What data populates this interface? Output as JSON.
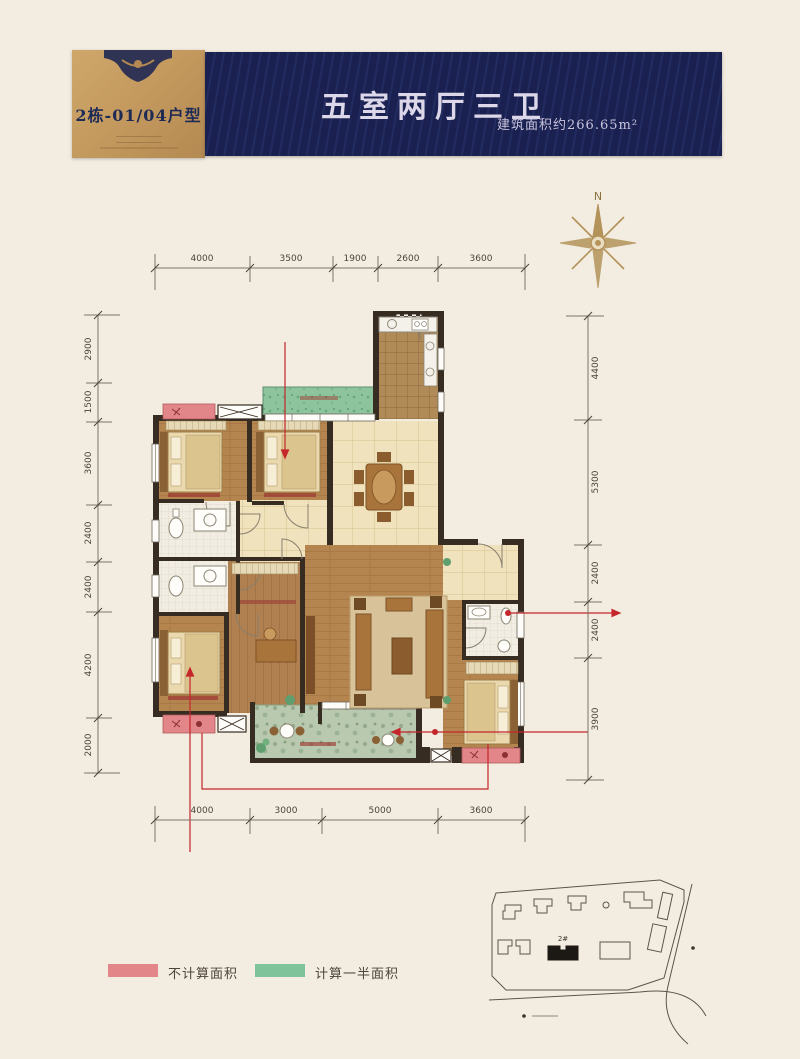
{
  "header": {
    "unit_label": "2栋-01/04户型",
    "title": "五室两厅三卫",
    "area_note": "建筑面积约266.65m²"
  },
  "compass": {
    "label": "N"
  },
  "dimensions": {
    "top": [
      "4000",
      "3500",
      "1900",
      "2600",
      "3600"
    ],
    "bottom": [
      "4000",
      "3000",
      "5000",
      "3600"
    ],
    "left": [
      "2900",
      "1500",
      "3600",
      "2400",
      "2400",
      "4200",
      "2000"
    ],
    "right": [
      "4400",
      "5300",
      "2400",
      "2400",
      "3900"
    ]
  },
  "legend": {
    "items": [
      {
        "label": "不计算面积",
        "color": "#e2868a"
      },
      {
        "label": "计算一半面积",
        "color": "#7fc39b"
      }
    ]
  },
  "site_map": {
    "highlight_label": "2#"
  },
  "colors": {
    "background": "#f3ede1",
    "banner": "#1a2150",
    "gold": "#c49a5f",
    "wall": "#362c22",
    "red_overlay": "#c4262b",
    "compass": "#b3935a"
  }
}
